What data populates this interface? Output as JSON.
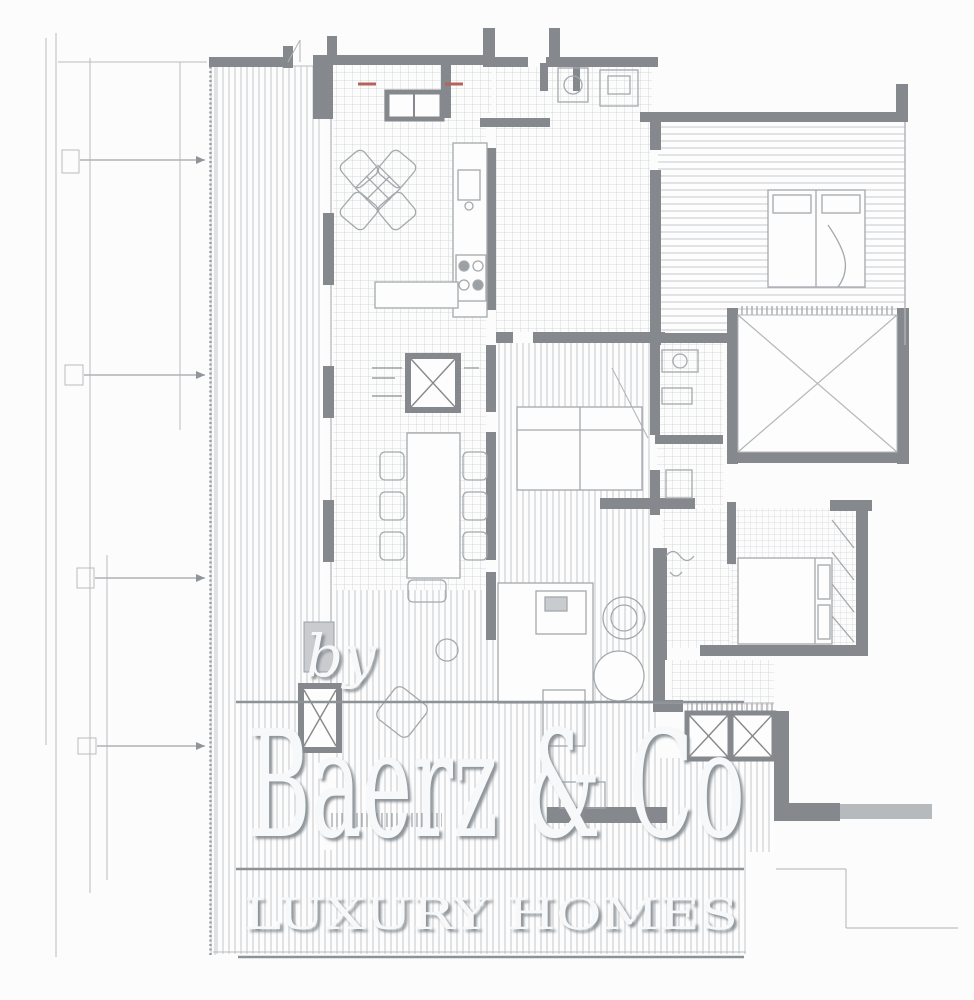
{
  "watermark": {
    "byline": "by",
    "brand": "Baerz & Co",
    "tagline": "LUXURY HOMES"
  },
  "colors": {
    "background": "#fcfcfc",
    "wall": "#85888c",
    "wall_light": "#b7babd",
    "thin_line": "#b9bdc1",
    "tile_line": "#cdd0d2",
    "stripe_line": "#c3c6c9",
    "furniture_line": "#a4a9ad",
    "hatch_tick": "#9aa0a4",
    "accent_red": "#b4625a",
    "watermark_fill": "#f7f8f9",
    "watermark_shadow": "#858b91",
    "rule_line": "#8d9297"
  }
}
